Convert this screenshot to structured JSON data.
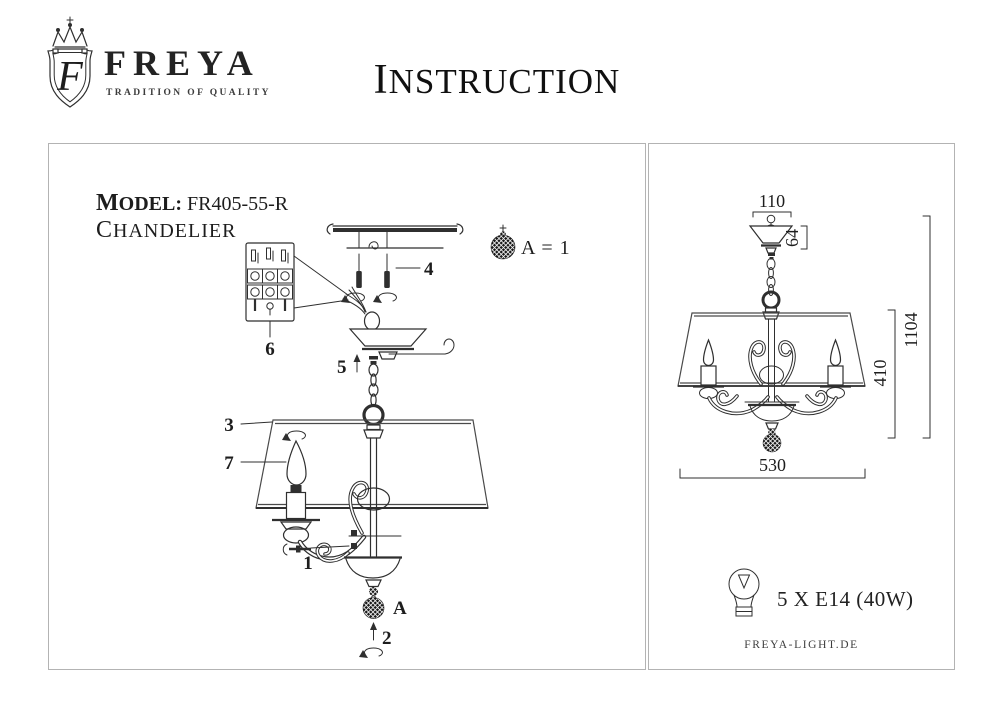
{
  "header": {
    "logo_letter": "F",
    "brand": "FREYA",
    "tagline": "TRADITION OF QUALITY",
    "title": "INSTRUCTION"
  },
  "left_panel": {
    "model_label": "MODEL:",
    "model_value": "FR405-55-R",
    "product_type": "CHANDELIER",
    "legend_text": "A = 1",
    "part_labels": {
      "n1": "1",
      "n2": "2",
      "n3": "3",
      "n4": "4",
      "n5": "5",
      "n6": "6",
      "n7": "7",
      "a": "A"
    }
  },
  "right_panel": {
    "dimensions": {
      "canopy_width_mm": "110",
      "canopy_height_mm": "64",
      "shade_height_mm": "410",
      "total_height_mm": "1104",
      "total_width_mm": "530"
    },
    "bulb_spec": "5 X E14 (40W)",
    "website": "FREYA-LIGHT.DE"
  },
  "icons": {
    "brand_crest": "shield-crest-icon",
    "crystal_ball": "crystal-ball-icon",
    "light_bulb": "light-bulb-icon",
    "rotate_arrow": "rotate-arrow-icon",
    "up_arrow": "up-arrow-icon",
    "screw": "screw-icon",
    "hook": "hook-icon"
  },
  "colors": {
    "ink": "#2f2f2f",
    "panel_border": "#b3b3b3",
    "background": "#ffffff"
  }
}
